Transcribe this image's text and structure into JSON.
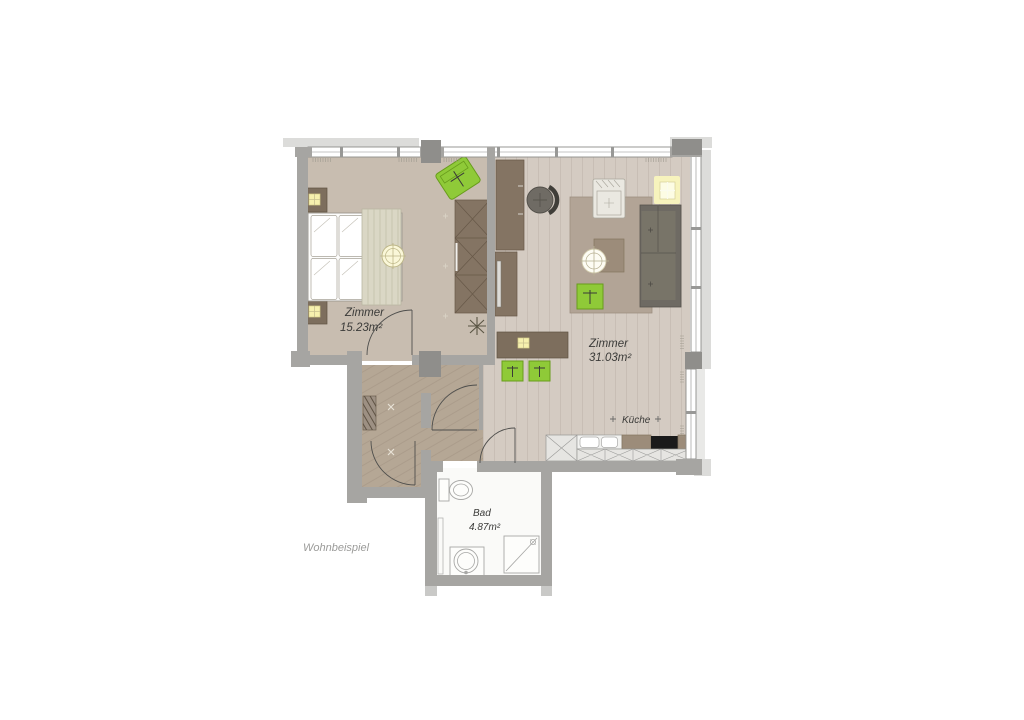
{
  "caption": {
    "text": "Wohnbeispiel"
  },
  "rooms": {
    "bedroom": {
      "name": "Zimmer",
      "area": "15.23m²"
    },
    "living_room": {
      "name": "Zimmer",
      "area": "31.03m²"
    },
    "kitchen": {
      "name": "Küche"
    },
    "bathroom": {
      "name": "Bad",
      "area": "4.87m²"
    }
  },
  "palette": {
    "wall_gray": "#a6a5a2",
    "pillar_gray": "#8f8e8b",
    "slab_light_gray": "#dcdcda",
    "bedroom_floor": "#c8bdb0",
    "living_floor": "#d4cbc2",
    "hall_floor": "#b5a795",
    "bath_floor": "#fafaf8",
    "furniture_brown": "#847463",
    "accent_green": "#8fca38",
    "accent_yellow": "#f6f0ae",
    "sofa_gray": "#6e6a63",
    "rug_taupe": "#b2a496",
    "label_color": "#3b3b39",
    "caption_color": "#9b9b99"
  },
  "furniture_icons": [
    "double-bed",
    "pillows",
    "blanket",
    "nightstand",
    "bedside-lamp",
    "ceiling-lamp",
    "wardrobe",
    "lounge-chair",
    "plant",
    "desk",
    "office-chair",
    "tv-sideboard",
    "dining-table",
    "pendant-lamp",
    "dining-chair",
    "rug",
    "armchair",
    "sofa",
    "side-table",
    "floor-lamp",
    "ottoman",
    "window-lamp",
    "coat-rack",
    "kitchen-tall-cabinet",
    "kitchen-sink",
    "cooktop",
    "kitchen-cabinets",
    "toilet",
    "washbasin",
    "shower"
  ]
}
